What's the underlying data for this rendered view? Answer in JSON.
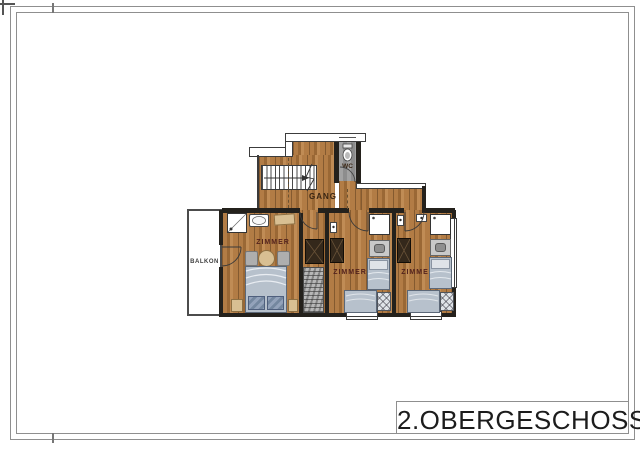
{
  "title_block": {
    "text": "2.OBERGESCHOSS"
  },
  "plan": {
    "hallway": {
      "label": "GANG"
    },
    "wc": {
      "label": "WC"
    },
    "balcony": {
      "label": "BALKON"
    },
    "rooms": [
      {
        "label": "ZIMMER"
      },
      {
        "label": "ZIMMER"
      },
      {
        "label": "ZIMMER"
      }
    ],
    "colors": {
      "wall_dark": "#24211c",
      "wood_a": "#b27c45",
      "wood_b": "#9a6835",
      "wood_c": "#c08c55",
      "tile_gray": "#8d8d8d",
      "bed_fill": "#b7c1cc",
      "bed_line": "#5c6878",
      "pillow_dark": "#74879f",
      "pillow_light": "#dfe3e8",
      "furn_tan": "#d8bf92",
      "furn_tan_border": "#8d6f42",
      "wardrobe": "#34281b",
      "chair_gray": "#aeaeae",
      "label_room": "#54231d",
      "label_hall": "#3a2614",
      "label_balcony": "#3f3f3f",
      "frame_gray": "#8f8f8f",
      "title_color": "#1c1c1c"
    }
  }
}
